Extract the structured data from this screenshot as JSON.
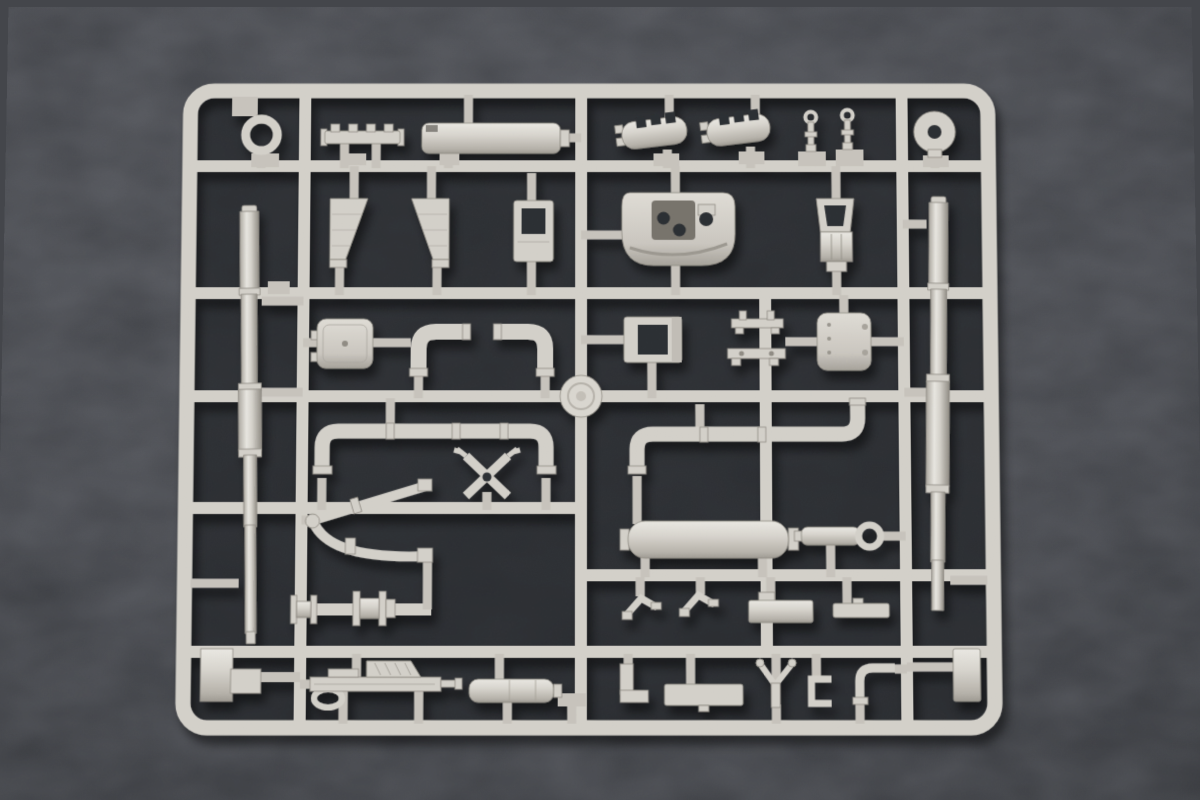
{
  "image": {
    "kind": "photograph",
    "subject": "Unpainted light-grey injection-molded plastic model kit sprue (parts tree) for an armored vehicle kit",
    "surface": "dark charcoal felt / carpet background",
    "text_visible": "none",
    "part_count_approx": 44
  },
  "colors": {
    "bg": "#44464b",
    "bg_dark": "#313338",
    "interior": "#232529",
    "plastic": "#d2cfc8",
    "plastic_hi": "#e9e7e1",
    "plastic_mid": "#c6c2bb",
    "plastic_sh": "#a29e96",
    "plastic_deep": "#85817a",
    "recess": "#76726a",
    "hole": "#2b2d30"
  },
  "sprue": {
    "frame": {
      "x": 178,
      "y": 78,
      "width": 822,
      "height": 656,
      "corner_radius": 26,
      "rail_thickness": 15
    },
    "horizontal_runners_y": [
      163,
      292,
      396,
      508,
      575,
      651
    ],
    "vertical_runners_x": [
      302,
      581,
      766,
      905
    ],
    "injection_boss": {
      "cx": 581,
      "cy": 396,
      "r": 21
    }
  },
  "parts": [
    {
      "id": "towing-ring",
      "desc": "small ring",
      "cx": 258,
      "cy": 131
    },
    {
      "id": "notched-rail",
      "desc": "bar with four lugs",
      "cx": 360,
      "cy": 131
    },
    {
      "id": "smoke-cylinder-top",
      "desc": "long horizontal cylinder",
      "cx": 490,
      "cy": 134
    },
    {
      "id": "muffler-left",
      "desc": "slotted exhaust muffler",
      "cx": 655,
      "cy": 130
    },
    {
      "id": "muffler-right",
      "desc": "slotted exhaust muffler",
      "cx": 740,
      "cy": 127
    },
    {
      "id": "lifting-pin-1",
      "desc": "small eyelet pin",
      "cx": 813,
      "cy": 128
    },
    {
      "id": "lifting-pin-2",
      "desc": "small eyelet pin",
      "cx": 850,
      "cy": 126
    },
    {
      "id": "idler-disc",
      "desc": "disc with center hole",
      "cx": 938,
      "cy": 128
    },
    {
      "id": "gun-barrel-left",
      "desc": "long stepped gun barrel",
      "cx": 249,
      "cy": 420
    },
    {
      "id": "gun-barrel-right",
      "desc": "long stepped gun barrel",
      "cx": 939,
      "cy": 400
    },
    {
      "id": "mud-flap-left",
      "desc": "trapezoid splash guard",
      "cx": 347,
      "cy": 228
    },
    {
      "id": "mud-flap-right",
      "desc": "trapezoid splash guard",
      "cx": 429,
      "cy": 228
    },
    {
      "id": "periscope-housing",
      "desc": "frame with square opening",
      "cx": 533,
      "cy": 228
    },
    {
      "id": "cupola-shell",
      "desc": "curved drum shell with recess and holes",
      "cx": 678,
      "cy": 226
    },
    {
      "id": "crew-seat",
      "desc": "seat with frame backrest",
      "cx": 837,
      "cy": 230
    },
    {
      "id": "hatch-left",
      "desc": "rounded hatch with hinges",
      "cx": 344,
      "cy": 343
    },
    {
      "id": "elbow-pipe-left",
      "desc": "90-degree elbow pipe",
      "cx": 440,
      "cy": 350
    },
    {
      "id": "elbow-pipe-right",
      "desc": "90-degree elbow pipe",
      "cx": 522,
      "cy": 350
    },
    {
      "id": "open-frame",
      "desc": "frame with rectangular opening",
      "cx": 653,
      "cy": 339
    },
    {
      "id": "twin-post-bracket",
      "desc": "bar with two posts",
      "cx": 758,
      "cy": 320
    },
    {
      "id": "footed-bar",
      "desc": "bar with two feet",
      "cx": 757,
      "cy": 356
    },
    {
      "id": "hatch-right",
      "desc": "rounded hatch with hinge dots",
      "cx": 845,
      "cy": 341
    },
    {
      "id": "injection-boss",
      "desc": "round sprue gate disc",
      "cx": 581,
      "cy": 396
    },
    {
      "id": "u-pipe-long",
      "desc": "long pipe with both ends bent down",
      "cx": 434,
      "cy": 450
    },
    {
      "id": "s-pipe-long",
      "desc": "long pipe bent down left, up right",
      "cx": 747,
      "cy": 437
    },
    {
      "id": "gun-cradle-x",
      "desc": "x-shaped mount bracket",
      "cx": 487,
      "cy": 477
    },
    {
      "id": "fork-pipe",
      "desc": "forked twin-arm pipe",
      "cx": 370,
      "cy": 520
    },
    {
      "id": "fuel-drum",
      "desc": "large smooth cylinder",
      "cx": 708,
      "cy": 540
    },
    {
      "id": "recoil-cylinder",
      "desc": "cylinder with ring end",
      "cx": 838,
      "cy": 536
    },
    {
      "id": "angle-bracket-1",
      "desc": "bent strip bracket",
      "cx": 641,
      "cy": 607
    },
    {
      "id": "angle-bracket-2",
      "desc": "bent strip bracket",
      "cx": 698,
      "cy": 604
    },
    {
      "id": "stowage-block",
      "desc": "rectangular block",
      "cx": 780,
      "cy": 611
    },
    {
      "id": "flat-strip",
      "desc": "flat bar",
      "cx": 860,
      "cy": 610
    },
    {
      "id": "roller-spool-1",
      "desc": "small flanged spool",
      "cx": 305,
      "cy": 609
    },
    {
      "id": "roller-spool-2",
      "desc": "large flanged spool",
      "cx": 370,
      "cy": 609
    },
    {
      "id": "stepped-block",
      "desc": "stepped mounting block",
      "cx": 230,
      "cy": 675
    },
    {
      "id": "machine-gun",
      "desc": "detailed machine gun body",
      "cx": 383,
      "cy": 686
    },
    {
      "id": "ribbed-cylinder",
      "desc": "short ribbed cylinder",
      "cx": 512,
      "cy": 689
    },
    {
      "id": "l-bracket",
      "desc": "L-shaped bracket",
      "cx": 633,
      "cy": 681
    },
    {
      "id": "flat-bar-bottom",
      "desc": "rectangular bar",
      "cx": 703,
      "cy": 693
    },
    {
      "id": "y-fork",
      "desc": "y-shaped linkage",
      "cx": 775,
      "cy": 684
    },
    {
      "id": "c-bracket",
      "desc": "c-shaped clamp",
      "cx": 819,
      "cy": 690
    },
    {
      "id": "small-elbow",
      "desc": "small elbow pipe",
      "cx": 874,
      "cy": 683
    },
    {
      "id": "edge-block",
      "desc": "vertical block",
      "cx": 964,
      "cy": 674
    }
  ]
}
